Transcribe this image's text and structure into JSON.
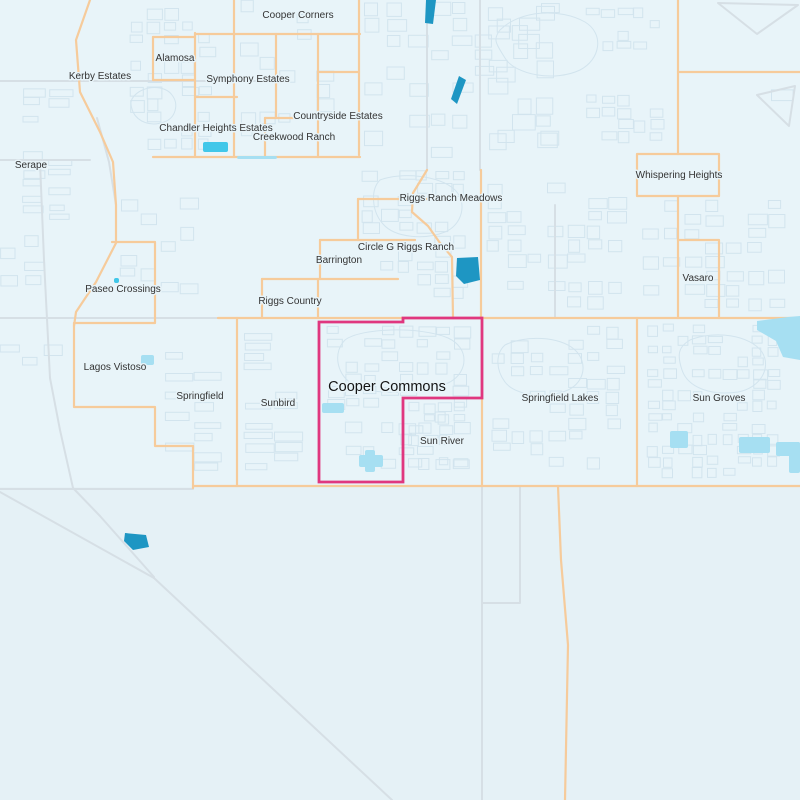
{
  "map": {
    "selected_neighborhood": "Cooper Commons",
    "colors": {
      "bg": "#E8F4F9",
      "bg_lower": "#E5F1F6",
      "parcel": "#D2E4EE",
      "road_gray": "#D6DFE5",
      "road_orange": "#F6CB9B",
      "boundary_pink": "#E0377F",
      "water_dark": "#1E96C3",
      "water_bright": "#41C7E9",
      "water_pale": "#A6DFF2",
      "label": "#333333",
      "label_big": "#141414",
      "halo": "#E8F4F9"
    },
    "selection_boundary": [
      [
        319,
        322
      ],
      [
        403,
        322
      ],
      [
        403,
        318
      ],
      [
        482,
        318
      ],
      [
        482,
        398
      ],
      [
        403,
        398
      ],
      [
        403,
        482
      ],
      [
        319,
        482
      ]
    ],
    "labels": [
      {
        "text": "Cooper Corners",
        "x": 298,
        "y": 18,
        "size": "small"
      },
      {
        "text": "Alamosa",
        "x": 175,
        "y": 61,
        "size": "small"
      },
      {
        "text": "Kerby Estates",
        "x": 100,
        "y": 79,
        "size": "small"
      },
      {
        "text": "Symphony Estates",
        "x": 248,
        "y": 82,
        "size": "small"
      },
      {
        "text": "Countryside Estates",
        "x": 338,
        "y": 119,
        "size": "small"
      },
      {
        "text": "Chandler Heights Estates",
        "x": 216,
        "y": 131,
        "size": "small"
      },
      {
        "text": "Creekwood Ranch",
        "x": 294,
        "y": 140,
        "size": "small"
      },
      {
        "text": "Serape",
        "x": 31,
        "y": 168,
        "size": "small"
      },
      {
        "text": "Whispering Heights",
        "x": 679,
        "y": 178,
        "size": "small"
      },
      {
        "text": "Riggs Ranch Meadows",
        "x": 451,
        "y": 201,
        "size": "small"
      },
      {
        "text": "Circle G Riggs Ranch",
        "x": 406,
        "y": 250,
        "size": "small"
      },
      {
        "text": "Barrington",
        "x": 339,
        "y": 263,
        "size": "small"
      },
      {
        "text": "Vasaro",
        "x": 698,
        "y": 281,
        "size": "small"
      },
      {
        "text": "Paseo Crossings",
        "x": 123,
        "y": 292,
        "size": "small"
      },
      {
        "text": "Riggs Country",
        "x": 290,
        "y": 304,
        "size": "small"
      },
      {
        "text": "Lagos Vistoso",
        "x": 115,
        "y": 370,
        "size": "small"
      },
      {
        "text": "Cooper Commons",
        "x": 387,
        "y": 391,
        "size": "large"
      },
      {
        "text": "Springfield",
        "x": 200,
        "y": 399,
        "size": "small"
      },
      {
        "text": "Springfield Lakes",
        "x": 560,
        "y": 401,
        "size": "small"
      },
      {
        "text": "Sun Groves",
        "x": 719,
        "y": 401,
        "size": "small"
      },
      {
        "text": "Sunbird",
        "x": 278,
        "y": 406,
        "size": "small"
      },
      {
        "text": "Sun River",
        "x": 442,
        "y": 444,
        "size": "small"
      }
    ],
    "roads": {
      "gray": [
        [
          [
            0,
            318
          ],
          [
            218,
            318
          ]
        ],
        [
          [
            0,
            489
          ],
          [
            193,
            489
          ]
        ],
        [
          [
            40,
            162
          ],
          [
            44,
            260
          ],
          [
            50,
            378
          ]
        ],
        [
          [
            50,
            378
          ],
          [
            60,
            430
          ],
          [
            73,
            488
          ],
          [
            100,
            516
          ],
          [
            154,
            577
          ]
        ],
        [
          [
            0,
            492
          ],
          [
            154,
            578
          ]
        ],
        [
          [
            154,
            578
          ],
          [
            392,
            800
          ]
        ],
        [
          [
            97,
            118
          ],
          [
            109,
            162
          ],
          [
            116,
            205
          ],
          [
            116,
            240
          ]
        ],
        [
          [
            0,
            81
          ],
          [
            281,
            81
          ]
        ],
        [
          [
            482,
            486
          ],
          [
            482,
            800
          ]
        ],
        [
          [
            520,
            486
          ],
          [
            520,
            603
          ],
          [
            482,
            603
          ]
        ],
        [
          [
            555,
            205
          ],
          [
            555,
            318
          ]
        ],
        [
          [
            427,
            0
          ],
          [
            427,
            170
          ]
        ],
        [
          [
            480,
            0
          ],
          [
            480,
            170
          ]
        ],
        [
          [
            718,
            3
          ],
          [
            798,
            5
          ],
          [
            757,
            34
          ],
          [
            718,
            3
          ]
        ],
        [
          [
            757,
            95
          ],
          [
            795,
            86
          ],
          [
            789,
            126
          ],
          [
            757,
            95
          ]
        ],
        [
          [
            0,
            160
          ],
          [
            90,
            160
          ]
        ]
      ],
      "orange": [
        [
          [
            90,
            0
          ],
          [
            76,
            40
          ],
          [
            80,
            92
          ],
          [
            100,
            132
          ],
          [
            113,
            162
          ],
          [
            116,
            205
          ],
          [
            116,
            243
          ],
          [
            96,
            282
          ],
          [
            76,
            312
          ],
          [
            74,
            326
          ]
        ],
        [
          [
            74,
            323
          ],
          [
            74,
            407
          ],
          [
            155,
            407
          ],
          [
            155,
            446
          ],
          [
            193,
            446
          ],
          [
            193,
            488
          ]
        ],
        [
          [
            74,
            323
          ],
          [
            155,
            323
          ],
          [
            155,
            242
          ],
          [
            112,
            242
          ]
        ],
        [
          [
            218,
            318
          ],
          [
            800,
            318
          ]
        ],
        [
          [
            193,
            486
          ],
          [
            800,
            486
          ]
        ],
        [
          [
            234,
            0
          ],
          [
            234,
            157
          ]
        ],
        [
          [
            195,
            33
          ],
          [
            195,
            157
          ]
        ],
        [
          [
            153,
            37
          ],
          [
            195,
            37
          ]
        ],
        [
          [
            153,
            37
          ],
          [
            153,
            80
          ],
          [
            195,
            80
          ]
        ],
        [
          [
            195,
            34
          ],
          [
            360,
            34
          ]
        ],
        [
          [
            276,
            34
          ],
          [
            276,
            118
          ]
        ],
        [
          [
            318,
            34
          ],
          [
            318,
            157
          ]
        ],
        [
          [
            359,
            0
          ],
          [
            359,
            155
          ]
        ],
        [
          [
            318,
            72
          ],
          [
            359,
            72
          ]
        ],
        [
          [
            195,
            97
          ],
          [
            237,
            97
          ]
        ],
        [
          [
            265,
            118
          ],
          [
            318,
            118
          ]
        ],
        [
          [
            265,
            118
          ],
          [
            265,
            157
          ]
        ],
        [
          [
            153,
            157
          ],
          [
            360,
            157
          ]
        ],
        [
          [
            427,
            170
          ],
          [
            413,
            193
          ],
          [
            412,
            212
          ],
          [
            428,
            226
          ],
          [
            440,
            243
          ],
          [
            452,
            257
          ],
          [
            453,
            318
          ]
        ],
        [
          [
            481,
            170
          ],
          [
            481,
            318
          ]
        ],
        [
          [
            358,
            199
          ],
          [
            427,
            199
          ]
        ],
        [
          [
            358,
            199
          ],
          [
            358,
            240
          ]
        ],
        [
          [
            320,
            240
          ],
          [
            415,
            240
          ]
        ],
        [
          [
            320,
            240
          ],
          [
            320,
            279
          ]
        ],
        [
          [
            262,
            279
          ],
          [
            398,
            279
          ]
        ],
        [
          [
            262,
            279
          ],
          [
            262,
            318
          ]
        ],
        [
          [
            318,
            279
          ],
          [
            318,
            318
          ]
        ],
        [
          [
            678,
            0
          ],
          [
            678,
            154
          ]
        ],
        [
          [
            678,
            72
          ],
          [
            800,
            72
          ]
        ],
        [
          [
            637,
            154
          ],
          [
            719,
            154
          ],
          [
            719,
            196
          ],
          [
            637,
            196
          ],
          [
            637,
            154
          ]
        ],
        [
          [
            678,
            196
          ],
          [
            678,
            240
          ]
        ],
        [
          [
            678,
            240
          ],
          [
            719,
            240
          ],
          [
            719,
            318
          ]
        ],
        [
          [
            678,
            240
          ],
          [
            678,
            318
          ]
        ],
        [
          [
            637,
            318
          ],
          [
            637,
            486
          ]
        ],
        [
          [
            237,
            318
          ],
          [
            237,
            486
          ]
        ],
        [
          [
            482,
            398
          ],
          [
            482,
            486
          ]
        ],
        [
          [
            558,
            486
          ],
          [
            561,
            560
          ],
          [
            568,
            645
          ],
          [
            565,
            800
          ]
        ]
      ]
    },
    "water": [
      {
        "color": "dark",
        "type": "polygon",
        "points": [
          [
            426,
            0
          ],
          [
            436,
            0
          ],
          [
            433,
            24
          ],
          [
            425,
            23
          ]
        ]
      },
      {
        "color": "dark",
        "type": "polygon",
        "points": [
          [
            451,
            99
          ],
          [
            459,
            76
          ],
          [
            466,
            80
          ],
          [
            457,
            104
          ]
        ]
      },
      {
        "color": "dark",
        "type": "polygon",
        "points": [
          [
            457,
            258
          ],
          [
            478,
            257
          ],
          [
            480,
            280
          ],
          [
            464,
            284
          ],
          [
            456,
            276
          ]
        ]
      },
      {
        "color": "dark",
        "type": "polygon",
        "points": [
          [
            125,
            533
          ],
          [
            146,
            535
          ],
          [
            149,
            547
          ],
          [
            133,
            550
          ],
          [
            124,
            541
          ]
        ]
      },
      {
        "color": "bright",
        "type": "rect",
        "rect": [
          203,
          142,
          25,
          10
        ]
      },
      {
        "color": "bright",
        "type": "rect",
        "rect": [
          114,
          278,
          5,
          5
        ]
      },
      {
        "color": "pale",
        "type": "rect",
        "rect": [
          141,
          355,
          13,
          10
        ]
      },
      {
        "color": "pale",
        "type": "rect",
        "rect": [
          322,
          403,
          22,
          10
        ]
      },
      {
        "color": "pale",
        "type": "rect",
        "rect": [
          359,
          455,
          24,
          12
        ]
      },
      {
        "color": "pale",
        "type": "rect",
        "rect": [
          365,
          450,
          10,
          22
        ]
      },
      {
        "color": "pale",
        "type": "polygon",
        "points": [
          [
            757,
            321
          ],
          [
            788,
            317
          ],
          [
            800,
            316
          ],
          [
            800,
            360
          ],
          [
            783,
            357
          ],
          [
            776,
            341
          ],
          [
            757,
            330
          ]
        ]
      },
      {
        "color": "pale",
        "type": "rect",
        "rect": [
          670,
          431,
          18,
          17
        ]
      },
      {
        "color": "pale",
        "type": "rect",
        "rect": [
          739,
          437,
          31,
          16
        ]
      },
      {
        "color": "pale",
        "type": "rect",
        "rect": [
          776,
          442,
          24,
          14
        ]
      },
      {
        "color": "pale",
        "type": "rect",
        "rect": [
          789,
          442,
          11,
          31
        ]
      },
      {
        "color": "pale",
        "type": "rect",
        "rect": [
          237,
          156,
          40,
          3
        ]
      }
    ]
  }
}
